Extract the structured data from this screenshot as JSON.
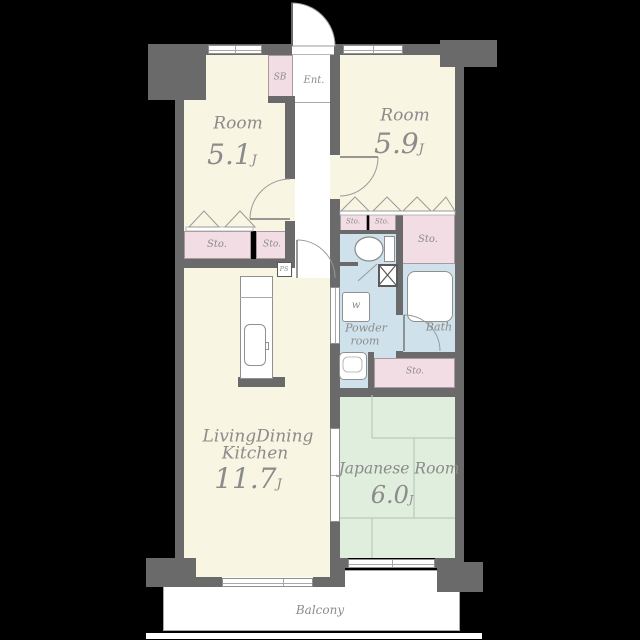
{
  "plan_title": "apartment-floor-plan",
  "colors": {
    "background": "#000000",
    "wall": "#6a6a6a",
    "room_fill": "#f8f5e3",
    "storage_fill": "#f3dde4",
    "wet_area_fill": "#cfe2ec",
    "tatami_fill": "#e0eedd",
    "text": "#8b8b8b"
  },
  "rooms": {
    "room_small_left": {
      "name": "Room",
      "size": "5.1",
      "size_unit": "J"
    },
    "room_small_right": {
      "name": "Room",
      "size": "5.9",
      "size_unit": "J"
    },
    "ldk": {
      "name_line1": "LivingDining",
      "name_line2": "Kitchen",
      "size": "11.7",
      "size_unit": "J"
    },
    "japanese_room": {
      "name": "Japanese Room",
      "size": "6.0",
      "size_unit": "J"
    },
    "powder_room": {
      "name_line1": "Powder",
      "name_line2": "room"
    },
    "bath": {
      "name": "Bath"
    },
    "entrance": {
      "name": "Ent."
    },
    "balcony": {
      "name": "Balcony"
    }
  },
  "labels": {
    "shoe_box": "SB",
    "storage": "Sto.",
    "pipe_shaft": "PS",
    "washing_machine": "w"
  }
}
